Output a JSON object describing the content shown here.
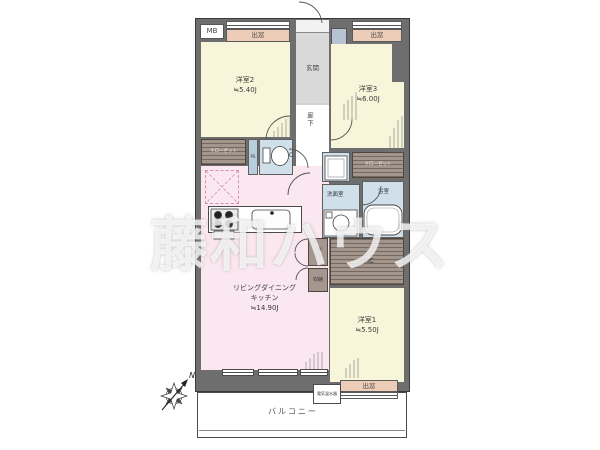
{
  "watermark": {
    "text": "藤和ハウス"
  },
  "compass": {
    "north": "N"
  },
  "plan": {
    "meter_box": "MB",
    "bay_window": "出窓",
    "entrance": "玄関",
    "entrance_storage": "玄関収納",
    "corridor": "廊下",
    "closet": "クローゼット",
    "pipe_space": "PS",
    "wc": "WC",
    "washroom": "洗面室",
    "bathroom": "浴室",
    "wic": "WIC",
    "cabinet": "物入",
    "storage": "収納",
    "balcony": "バルコニー",
    "water_heater": "電気温水器",
    "rooms": {
      "western2": {
        "name": "洋室2",
        "size": "≒5.40J"
      },
      "western3": {
        "name": "洋室3",
        "size": "≒6.00J"
      },
      "western1": {
        "name": "洋室1",
        "size": "≒5.50J"
      },
      "ldk": {
        "name_line1": "リビングダイニング",
        "name_line2": "キッチン",
        "size": "≒14.90J"
      }
    },
    "colors": {
      "wall": "#6e6e6e",
      "western_room": "#f7f6da",
      "ldk": "#fbe7f0",
      "bay_window": "#eecdb8",
      "wet_area": "#cfe0ea",
      "closet": "#a3968c",
      "entrance": "#d9d9d9",
      "entrance_storage": "#b7c2d3"
    }
  }
}
